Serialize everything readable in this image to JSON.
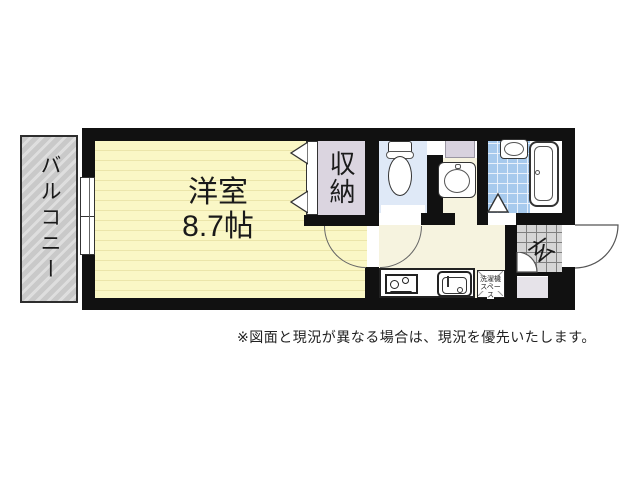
{
  "floorplan": {
    "balcony_label": "バルコニー",
    "main_room_name": "洋室",
    "main_room_size": "8.7帖",
    "closet_label": "収納",
    "entrance_label": "玄",
    "laundry_line1": "洗濯機",
    "laundry_line2": "スペース",
    "note": "※図面と現況が異なる場合は、現況を優先いたします。",
    "colors": {
      "wall": "#111111",
      "main_room_fill": "#FAF7C6",
      "main_room_stripe": "#EBE5AA",
      "balcony_fill": "#C9C9C9",
      "balcony_stripe": "#DEDEDE",
      "closet_fill": "#DBD5E0",
      "toilet_fill": "#DFE9F7",
      "bath_tile_fill": "#A7CAED",
      "hallway_fill": "#F6F3DF",
      "entrance_tile_fill": "#D5D5D5",
      "pipe_space_fill": "#D8D2DE",
      "below_entrance_fill": "#E6E3E9"
    }
  }
}
